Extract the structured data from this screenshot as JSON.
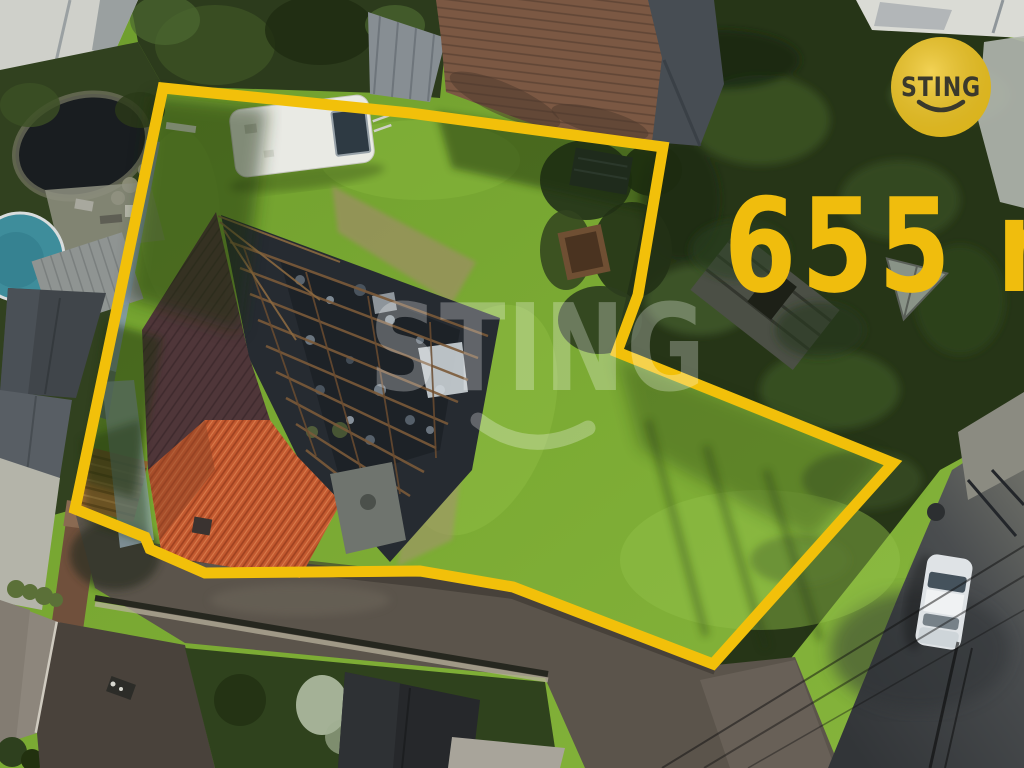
{
  "watermark": {
    "text": "STING"
  },
  "logo": {
    "text": "STING",
    "bg_color": "#EFC41C",
    "text_color": "#3A392C"
  },
  "area_label": {
    "text": "655 m",
    "color": "#F0BD0D"
  },
  "boundary": {
    "color": "#F2C00A"
  }
}
